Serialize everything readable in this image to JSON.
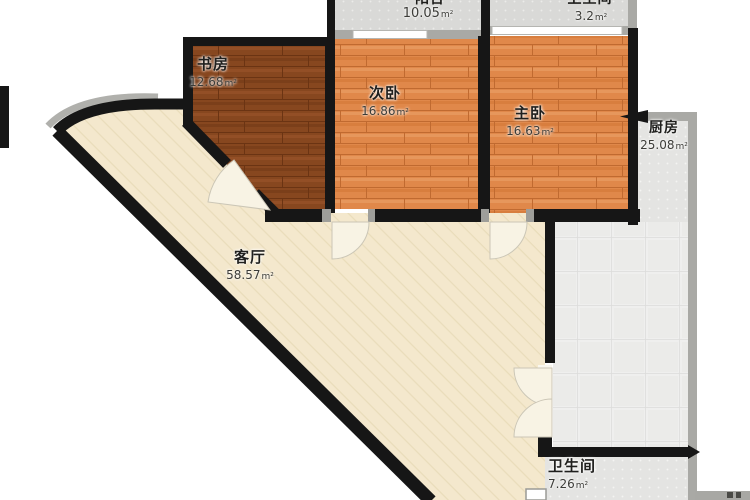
{
  "unit": "m²",
  "rooms": {
    "study": {
      "name": "书房",
      "area": "12.68"
    },
    "bedroom2": {
      "name": "次卧",
      "area": "16.86"
    },
    "master": {
      "name": "主卧",
      "area": "16.63"
    },
    "balcony": {
      "partial_name": "阳台",
      "area": "10.05"
    },
    "top_right": {
      "partial_name": "卫生间",
      "area": "3.2"
    },
    "kitchen": {
      "name": "厨房",
      "area": "25.08"
    },
    "living": {
      "name": "客厅",
      "area": "58.57"
    },
    "bathroom": {
      "name": "卫生间",
      "area": "7.26"
    }
  },
  "colors": {
    "wall": "#161616",
    "wall_gray": "#a9a9a5",
    "wood_brown": "#87471f",
    "wood_orange": "#e0884a",
    "floor_cream": "#f4e8cd",
    "tile_gray": "#d9d9d7",
    "tile_light": "#e9e9e7"
  }
}
